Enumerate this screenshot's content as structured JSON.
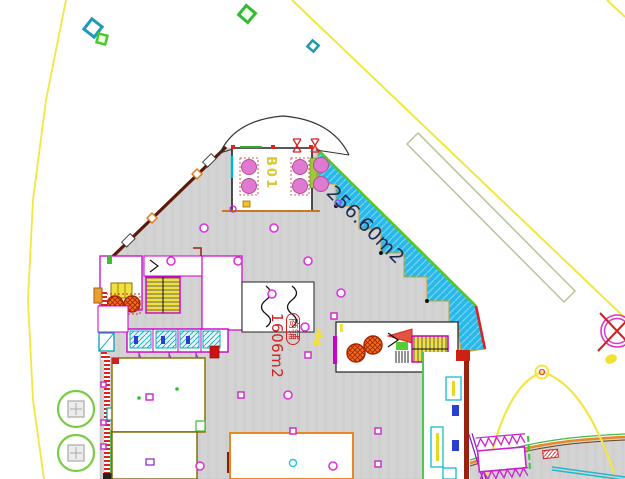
{
  "labels": {
    "terrace_area": "256.60m2",
    "hall_tag": "商铺",
    "hall_area": "1606m2",
    "vestibule": "B01"
  },
  "colors": {
    "floor_gray": "#d3d3d3",
    "floor_gray_stripe": "#cfcfcf",
    "terrace_fill": "#29b8ea",
    "terrace_border_green": "#55c822",
    "terrace_border_red": "#dd2222",
    "boundary_yellow": "#f2e740",
    "column_magenta": "#dd33dd",
    "wall_magenta": "#cc00cc",
    "perimeter_wall_maroon": "#5c1a0a",
    "area_text_red": "#d42020",
    "terrace_text_navy": "#1b2a56",
    "vestibule_text_yellow": "#d8c838",
    "stair_yellow": "#f0e040",
    "tank_orange": "#f07018",
    "escalator_purple": "#cc22cc",
    "plaza_band_orange": "#e8882a",
    "fixture_cyan": "#00a8c0",
    "tree_green": "#77cc44",
    "door_pink": "#e07ad0",
    "survey_rect_olive": "#b9c29a"
  }
}
